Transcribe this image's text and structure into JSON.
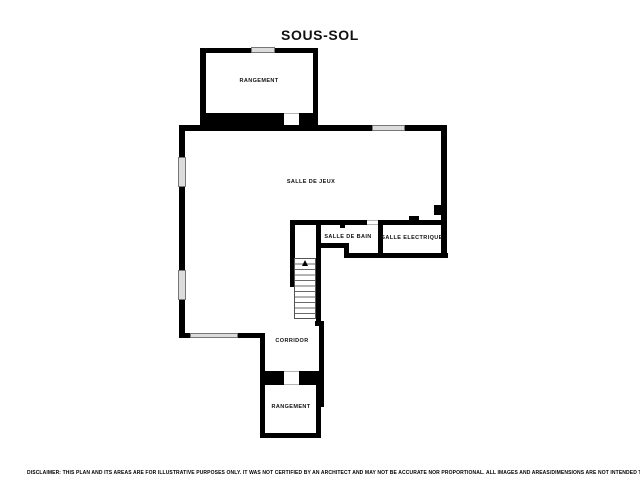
{
  "title": "SOUS-SOL",
  "rooms": {
    "storage_top": "RANGEMENT",
    "game_room": "SALLE DE JEUX",
    "bathroom": "SALLE DE BAIN",
    "electrical": "SALLE ELECTRIQUE",
    "corridor": "CORRIDOR",
    "storage_bottom": "RANGEMENT"
  },
  "disclaimer": "DISCLAIMER: THIS PLAN AND ITS AREAS ARE FOR ILLUSTRATIVE PURPOSES ONLY. IT WAS NOT CERTIFIED BY AN ARCHITECT AND MAY NOT BE ACCURATE NOR PROPORTIONAL. ALL IMAGES AND AREAS/DIMENSIONS ARE NOT INTENDED TO FORM ANY CONTRACT OR WARRANTY.",
  "colors": {
    "wall": "#000000",
    "window_fill": "#dcdcdc",
    "background": "#ffffff"
  }
}
